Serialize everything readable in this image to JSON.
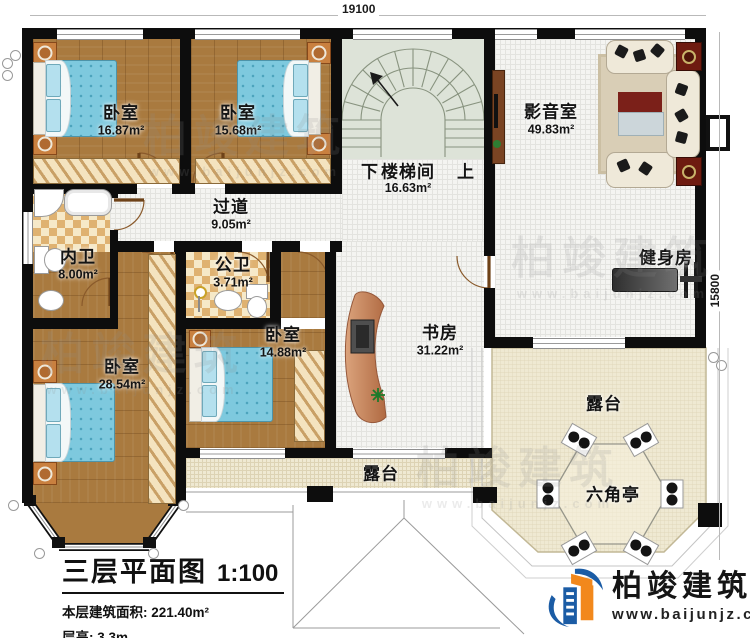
{
  "title_block": {
    "title": "三层平面图",
    "scale": "1:100",
    "area_label": "本层建筑面积:",
    "area_value": "221.40m²",
    "height_label": "层高:",
    "height_value": "3.3m"
  },
  "dimensions": {
    "top": "19100",
    "right": "15800"
  },
  "rooms": [
    {
      "id": "bedroom-1",
      "name": "卧室",
      "area": "16.87m²"
    },
    {
      "id": "bedroom-2",
      "name": "卧室",
      "area": "15.68m²"
    },
    {
      "id": "stairwell",
      "name": "楼梯间",
      "area": "16.63m²",
      "down": "下",
      "up": "上"
    },
    {
      "id": "media-room",
      "name": "影音室",
      "area": "49.83m²"
    },
    {
      "id": "corridor",
      "name": "过道",
      "area": "9.05m²"
    },
    {
      "id": "private-bath",
      "name": "内卫",
      "area": "8.00m²"
    },
    {
      "id": "public-bath",
      "name": "公卫",
      "area": "3.71m²"
    },
    {
      "id": "bedroom-3",
      "name": "卧室",
      "area": "28.54m²"
    },
    {
      "id": "bedroom-4",
      "name": "卧室",
      "area": "14.88m²"
    },
    {
      "id": "study",
      "name": "书房",
      "area": "31.22m²"
    },
    {
      "id": "gym",
      "name": "健身房"
    },
    {
      "id": "terrace-south",
      "name": "露台"
    },
    {
      "id": "terrace-east",
      "name": "露台"
    },
    {
      "id": "hex-pavilion",
      "name": "六角亭"
    }
  ],
  "branding": {
    "company": "柏竣建筑",
    "website": "www.baijunjz.com"
  },
  "watermark": {
    "company": "柏竣建筑",
    "website": "www.baijunjz.com"
  },
  "colors": {
    "wall": "#0d0d0d",
    "wood_floor": "#a97a3f",
    "tile": "#dfb271",
    "terrace": "#efe9d2",
    "stairs": "#dde3d8",
    "bed": "#7ec9de",
    "accent_red": "#6e1b10",
    "logo_blue": "#1b5ca5",
    "logo_orange": "#f2881c"
  }
}
